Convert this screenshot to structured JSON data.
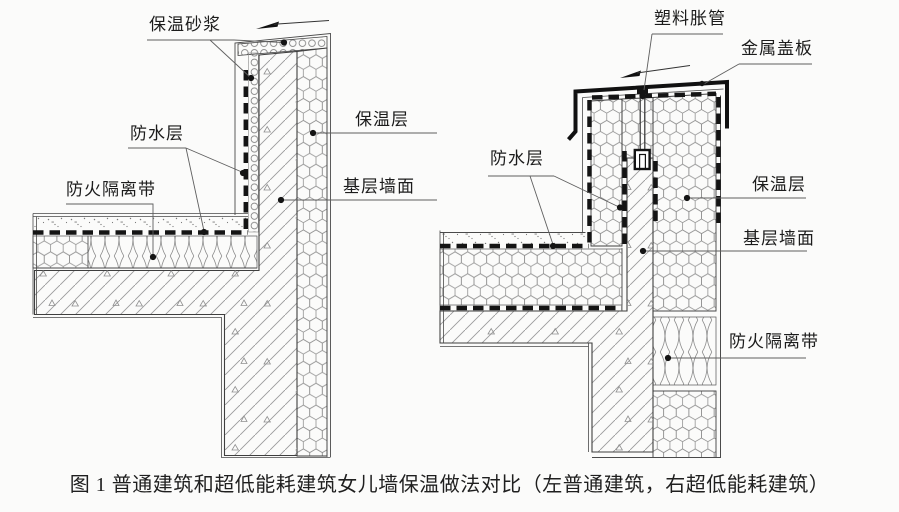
{
  "caption": "图 1 普通建筑和超低能耗建筑女儿墙保温做法对比（左普通建筑，右超低能耗建筑）",
  "left": {
    "labels": {
      "insulation_mortar": "保温砂浆",
      "waterproof_layer": "防水层",
      "fire_isolation_belt": "防火隔离带",
      "insulation_layer": "保温层",
      "base_wall_surface": "基层墙面"
    }
  },
  "right": {
    "labels": {
      "plastic_expansion_anchor": "塑料胀管",
      "metal_cover_plate": "金属盖板",
      "waterproof_layer": "防水层",
      "insulation_layer": "保温层",
      "base_wall_surface": "基层墙面",
      "fire_isolation_belt": "防火隔离带"
    }
  },
  "colors": {
    "background": "#fbfbfa",
    "line": "#3f3f3f",
    "pattern_line": "#8d8d8d",
    "waterproof_dash": "#141414",
    "text": "#1c1c1c"
  }
}
